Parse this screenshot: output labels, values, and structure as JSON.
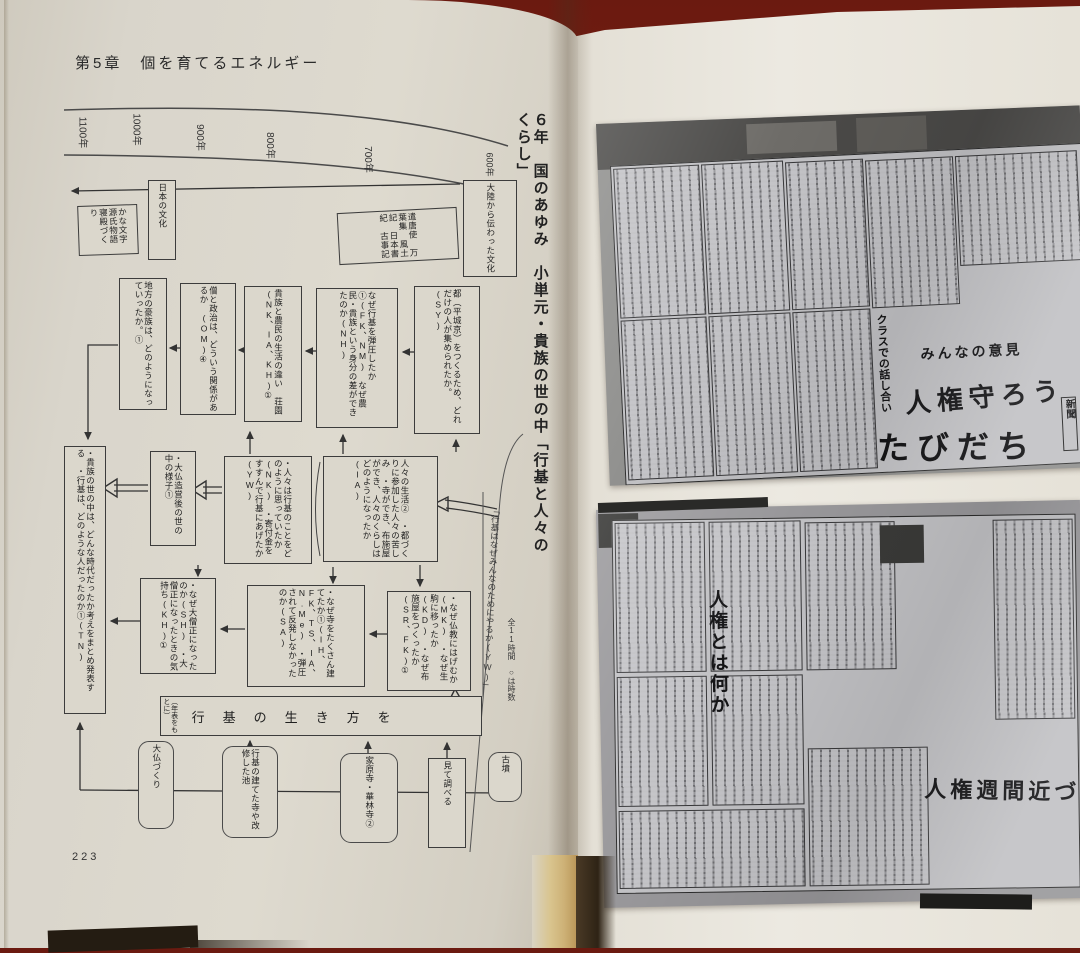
{
  "left": {
    "chapter": "第5章　個を育てるエネルギー",
    "page_no": "223",
    "title": "６年　国のあゆみ　小単元・貴族の世の中「行基と人々のくらし」",
    "quote": "「行基はなぜみんなのためにやるか(YW)」",
    "hours": "全11時間　○は時数",
    "years": [
      "1100年",
      "1000年",
      "900年",
      "800年",
      "700年",
      "600年"
    ],
    "boxes": [
      "大陸から伝わった文化",
      "日本の文化",
      "かな文字　源氏物語　寝殿づくり",
      "遣唐使　万葉集　風土記　日本書紀　古事記",
      "都（平城京）をつくるため、どれだけの人が集められたか。(SY)",
      "なぜ行基を弾圧したか①(FK、NM)　なぜ農民・貴族という身分の差ができたのか(NH)",
      "貴族と農民の生活の違い　荘園(NK、IA、KH)①",
      "僧と政治は、どういう関係があるか　(OM)④",
      "地方の豪族は、どのようになっていったか。①",
      "人々の生活②　・都づくりに参加した人々の苦しみ　・寺ができ、布施屋ができ、人々のくらしはどのようになったか(IA)",
      "・人々は行基のことをどのように思っていたか(NK)　・寄付金をすすんで行基にあげたか(YW)",
      "・大仏造営後の世の中の様子①",
      "・貴族の世の中は、どんな時代だったか考えをまとめ発表する　・行基は、どのような人だったのか①(TN)",
      "・なぜ仏教にはげむか(MK)　・なぜ生駒に移ったか(KD)　・なぜ布施屋をつくったか(SR、FK)①",
      "・なぜ寺をたくさん建てたか①(IH、FK、TS、IA、N.Me)　・弾圧されて反発しなかったのか(SA)",
      "・なぜ大僧正になったのか(SH)　・大僧正になったときの気持ち(KH)①"
    ],
    "wide": {
      "main": "行基の生き方を",
      "note": "（年表をもとに）"
    },
    "clouds": [
      "大仏づくり",
      "行基の建てた寺や改修した池",
      "家原寺・華林寺②",
      "見て調べる",
      "古墳"
    ]
  },
  "right": {
    "photo1": {
      "headline_sub": "みんなの意見",
      "headline_main": "人権守ろう",
      "masthead": "たびだち",
      "column_head": "クラスでの話し合い",
      "label": "新聞"
    },
    "photo2": {
      "headline_main": "人権とは何か",
      "headline_sub": "人権週間近づく"
    }
  }
}
